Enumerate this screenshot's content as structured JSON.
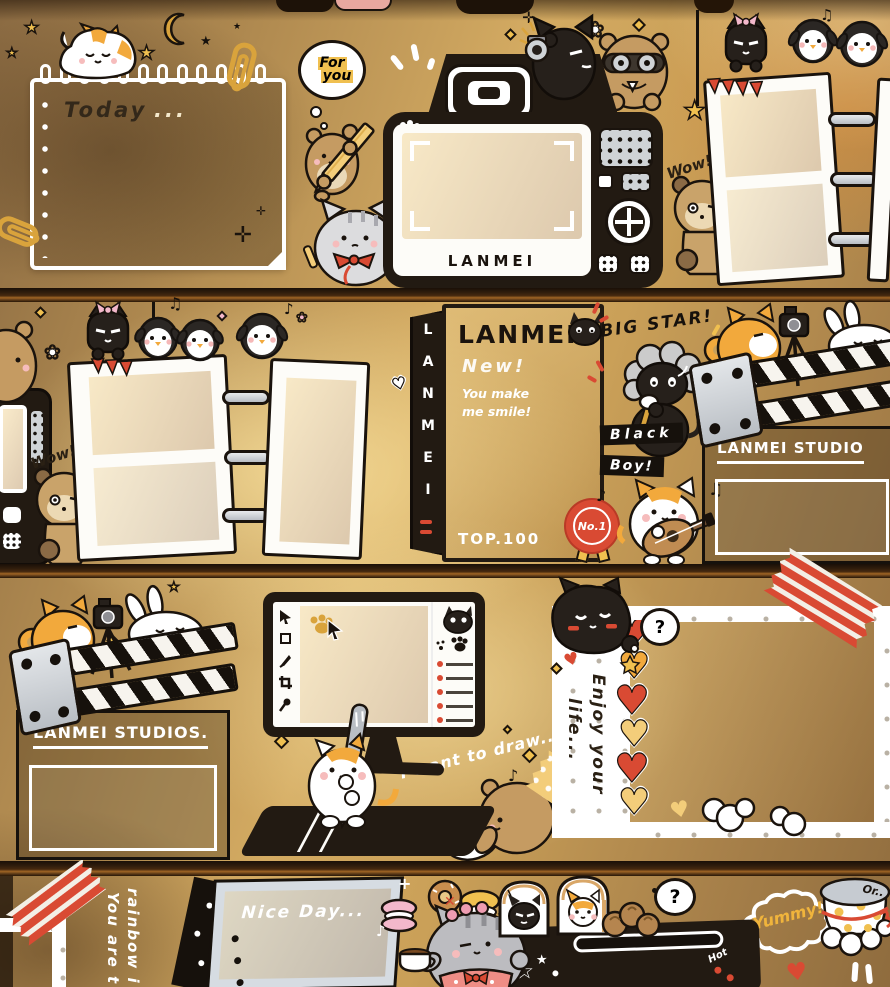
{
  "colors": {
    "background_gold": "#c9a05a",
    "outline_black": "#1a130d",
    "accent_orange": "#f2a93c",
    "accent_red": "#d94a33",
    "tape_yellow": "#f3cd7a",
    "paper_white": "#ffffff"
  },
  "row1": {
    "notepad_word": "Today",
    "notepad_dots": "...",
    "bubble_line1": "For",
    "bubble_line2": "you",
    "camera_brand": "LANMEI",
    "wow_label": "Wow!"
  },
  "row2": {
    "wow_label": "Wow!",
    "notepad_title": "LANMEI",
    "notepad_spine": "LANMEI",
    "notepad_new": "New!",
    "notepad_tagline1": "You make",
    "notepad_tagline2": "me smile!",
    "notepad_top": "TOP.100",
    "notepad_badge": "No.1",
    "big_star_label": "BIG STAR!",
    "black_label": "Black",
    "boy_label": "Boy!",
    "clapper_label": "LANMEI STUDIO"
  },
  "row3": {
    "clapper_label": "LANMEI STUDIOS.",
    "draw_caption": "I want to draw...",
    "enjoy_line1": "Enjoy your",
    "enjoy_line2": "life...",
    "question_mark": "?"
  },
  "row4": {
    "board_title": "Nice Day...",
    "vertical_line1": "You are t",
    "vertical_line2": "rainbow i",
    "question_mark": "?",
    "yummy_label": "Yummy!",
    "hot_label": "Hot",
    "bowl_label": "Or.."
  }
}
